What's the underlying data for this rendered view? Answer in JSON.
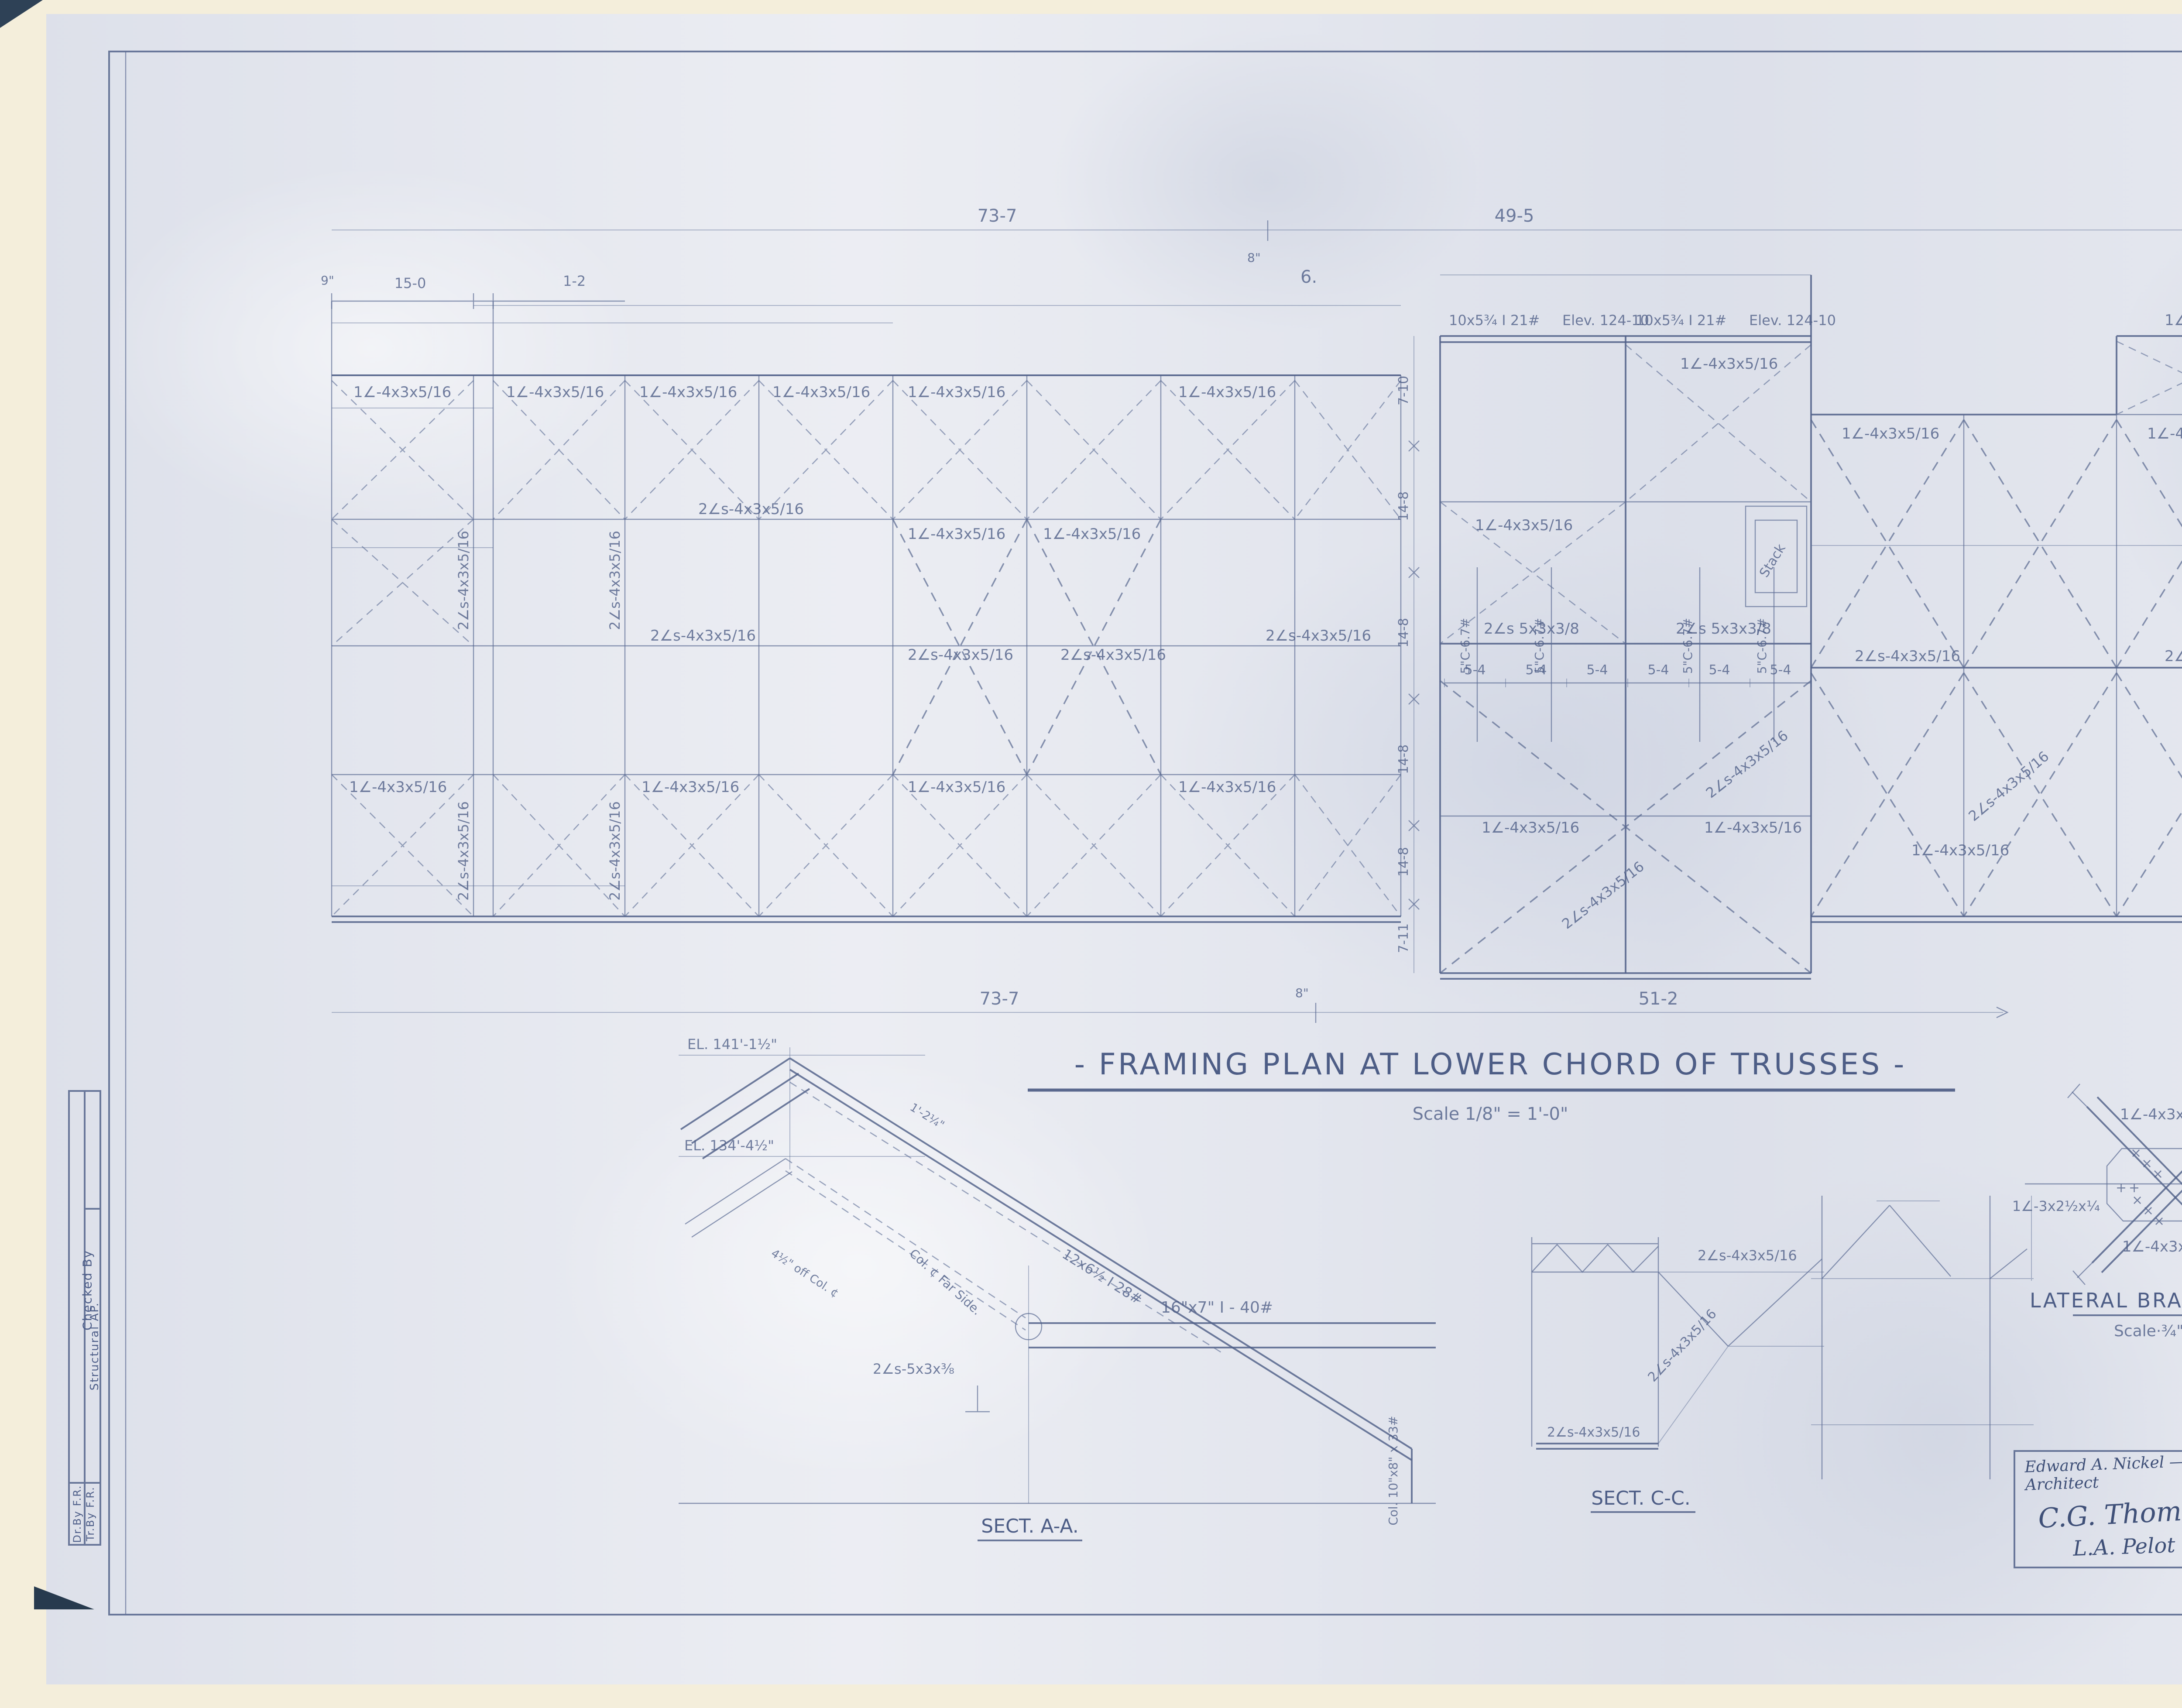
{
  "sheet": {
    "title": "- FRAMING PLAN AT LOWER CHORD OF TRUSSES -",
    "scale": "Scale  1/8\" = 1'-0\"",
    "mark": "6."
  },
  "dims": {
    "top_left": "73-7",
    "top_right": "49-5",
    "offset": "8\"",
    "bottom_left": "73-7",
    "bottom_right": "51-2",
    "nine": "9\"",
    "fifteen": "15-0",
    "one_two": "1-2",
    "panel": "5-4",
    "chain": [
      "7-10",
      "14-8",
      "14-8",
      "14-8",
      "14-8",
      "7-11"
    ]
  },
  "members": {
    "single_angle": "1∠-4x3x5/16",
    "double_angle": "2∠s-4x3x5/16",
    "double_angle_5": "2∠s 5x3x3/8",
    "channel": "5\"C-6.7#",
    "beam": "10x5¾ I 21#",
    "elev": "Elev. 124-10",
    "stack": "Stack"
  },
  "sect_aa": {
    "el_top": "EL. 141'-1½\"",
    "el_mid": "EL. 134'-4½\"",
    "rafter": "12x6½ I  28#",
    "dim_small": "1'-2¼\"",
    "off_col": "4½\" off Col. ¢",
    "far_side": "Col. ¢ Far Side.",
    "beam": "16\"x7\" I - 40#",
    "angles": "2∠s-5x3x⅜",
    "column": "Col. 10\"x8\" x 33#",
    "label": "SECT. A-A."
  },
  "sect_cc": {
    "label": "SECT. C-C."
  },
  "detail": {
    "title": "LATERAL BRACING DETAIL",
    "scale": "Scale·¾\" = 1'-0\"",
    "left_angle": "1∠-3x2½x¼"
  },
  "notes": {
    "heading": "THIS SHEET COVERS REVISIONS TO SHEET-S7.",
    "line1": "STEEL MEMBERS MARKED WITH SIZES, OR",
    "line2": "DIMENSIONS SHOWN, HAVE BEEN CHANGED OR ADDED.",
    "line3": "ALL OTHER MEMBERS AND DIMENSIONS ARE AS",
    "line4": "MARKED OR SHOWN ON ORIGINAL DRAWING.",
    "project": "P.W. PROJ.    F.P. #303   PHYS. IMP."
  },
  "titleblock": {
    "sig1": "Edward A. Nickel — For The Chief Architect",
    "sig2": "C.G. Thoman    Supt",
    "sig3": "L.A. Pelot",
    "dept1": "U.S. Department of the Interior.",
    "dept2": "NATIONAL PARK SERVICE",
    "park": "YOSEMITE NATIONAL PARK.",
    "building": "UTILITY BUILDING.",
    "drawn": "Drawn by Branch of Plans and Design.",
    "date_label": "Date",
    "date_value": "10/15/34",
    "sheet_line1": "Sheet 18",
    "sheet_line2": "of 33 Sheets",
    "drawing_label": "Drawing No.",
    "drawing_np": "N.P.",
    "drawing_no": "YOS. 3012 M.",
    "pwa": "PWA Project Completed Oct. 1935"
  },
  "margin": {
    "checked": "Checked By",
    "structural": "Structural AP.",
    "dr": "Dr.By F.R.",
    "tr": "Tr.By F.R."
  }
}
